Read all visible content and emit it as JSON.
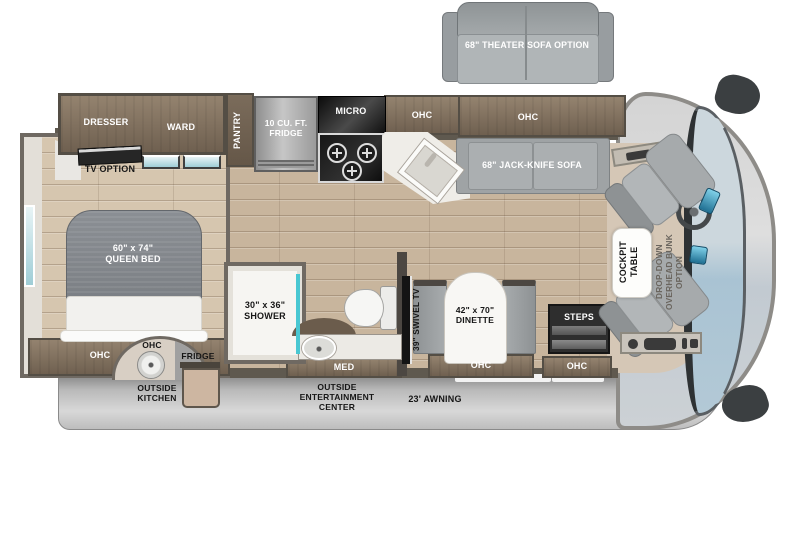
{
  "title": "Motorhome floor plan",
  "colors": {
    "floor_wood": "#c8b59d",
    "cabinet_brown": "#80705c",
    "wall_dark": "#5f594f",
    "window_teal": "#9fcdd6",
    "seat_gray": "#a6aaac",
    "awning_gray": "#b5b5b5",
    "counter_white": "#f6f5f2"
  },
  "options": {
    "theater_sofa": "68\" THEATER SOFA OPTION",
    "tv_option": "TV OPTION",
    "bunk": "DROP-DOWN\nOVERHEAD BUNK\nOPTION"
  },
  "bedroom": {
    "dresser": "DRESSER",
    "ward": "WARD",
    "pantry": "PANTRY",
    "bed": "60\" x 74\"\nQUEEN BED",
    "ohc": "OHC"
  },
  "kitchen": {
    "fridge": "10 CU. FT.\nFRIDGE",
    "micro": "MICRO",
    "ohc": "OHC"
  },
  "living": {
    "sofa_ohc": "OHC",
    "sofa": "68\" JACK-KNIFE SOFA",
    "swivel_tv": "39\" SWIVEL TV",
    "dinette": "42\" x 70\"\nDINETTE",
    "dinette_ohc": "OHC"
  },
  "bathroom": {
    "shower": "30\" x 36\"\nSHOWER",
    "med": "MED"
  },
  "entry": {
    "steps": "STEPS",
    "ohc": "OHC"
  },
  "cockpit": {
    "table": "COCKPIT\nTABLE"
  },
  "exterior": {
    "outside_kitchen_ohc": "OHC",
    "outside_fridge": "FRIDGE",
    "outside_kitchen": "OUTSIDE\nKITCHEN",
    "entertainment": "OUTSIDE\nENTERTAINMENT\nCENTER",
    "awning": "23' AWNING"
  }
}
